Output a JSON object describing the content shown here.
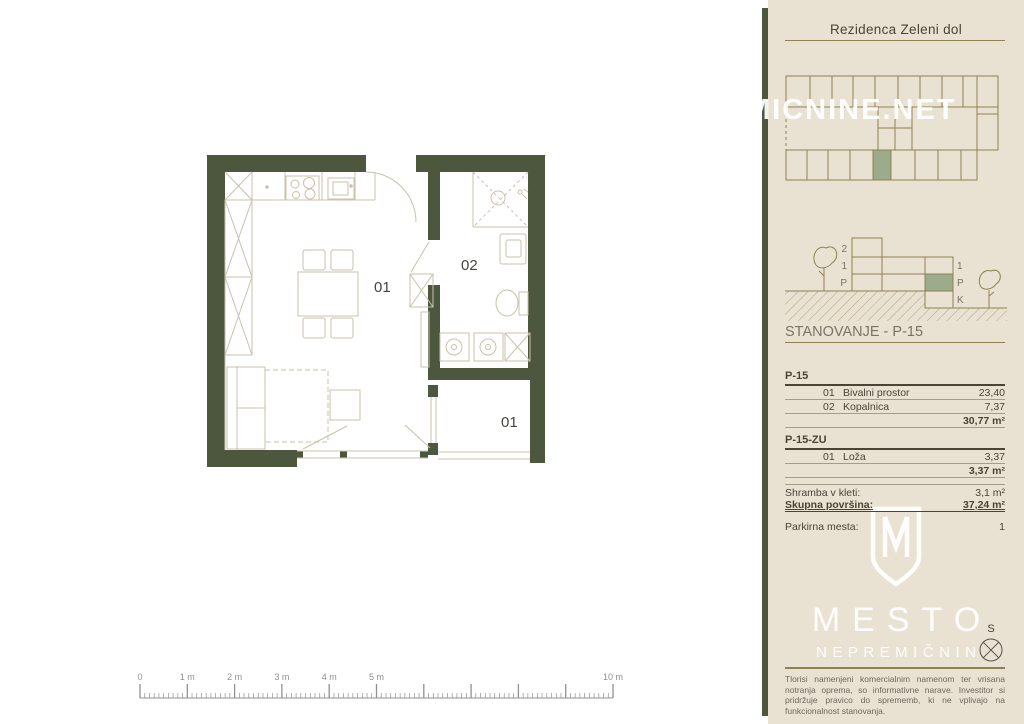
{
  "header": {
    "title": "Rezidenca Zeleni dol"
  },
  "watermark": {
    "text": "MICNINE.NET"
  },
  "elevation": {
    "left_labels": [
      "2",
      "1",
      "P"
    ],
    "right_labels": [
      "1",
      "P",
      "K"
    ]
  },
  "section": {
    "title": "STANOVANJE - P-15"
  },
  "areas": {
    "p15": {
      "header": "P-15",
      "rows": [
        {
          "no": "01",
          "name": "Bivalni prostor",
          "area": "23,40"
        },
        {
          "no": "02",
          "name": "Kopalnica",
          "area": "7,37"
        }
      ],
      "total": "30,77 m²"
    },
    "p15zu": {
      "header": "P-15-ZU",
      "rows": [
        {
          "no": "01",
          "name": "Loža",
          "area": "3,37"
        }
      ],
      "total": "3,37 m²"
    }
  },
  "summary": {
    "storage_label": "Shramba v kleti:",
    "storage_value": "3,1 m²",
    "total_label": "Skupna površina:",
    "total_value": "37,24 m²",
    "parking_label": "Parkirna mesta:",
    "parking_value": "1"
  },
  "logo": {
    "line1": "MESTO",
    "line2": "NEPREMIČNIN"
  },
  "compass": {
    "label": "S"
  },
  "disclaimer": {
    "text": "Tlorisi namenjeni komercialnim namenom ter vrisana notranja oprema, so informativne narave. Investitor si pridržuje pravico do sprememb, ki ne vplivajo na funkcionalnost stanovanja."
  },
  "plan": {
    "rooms": [
      {
        "name": "living-room",
        "label": "01"
      },
      {
        "name": "bathroom",
        "label": "02"
      },
      {
        "name": "loggia",
        "label": "01"
      }
    ]
  },
  "ruler": {
    "x0": 140,
    "y_base": 698,
    "step": 47.3,
    "meters": 10,
    "minors_per_meter": 10,
    "major_h": 14,
    "minor_h": 5,
    "labels": [
      {
        "at": 0,
        "text": "0"
      },
      {
        "at": 1,
        "text": "1 m"
      },
      {
        "at": 2,
        "text": "2 m"
      },
      {
        "at": 3,
        "text": "3 m"
      },
      {
        "at": 4,
        "text": "4 m"
      },
      {
        "at": 5,
        "text": "5 m"
      },
      {
        "at": 10,
        "text": "10 m"
      }
    ]
  },
  "colors": {
    "wall": "#4c573e",
    "plan_line": "#cac1ac",
    "sidebar_bg": "#e9e2d3",
    "sidebar_line": "#8e8150",
    "highlight_green": "#9cab8b",
    "text_dark": "#4a4437"
  }
}
